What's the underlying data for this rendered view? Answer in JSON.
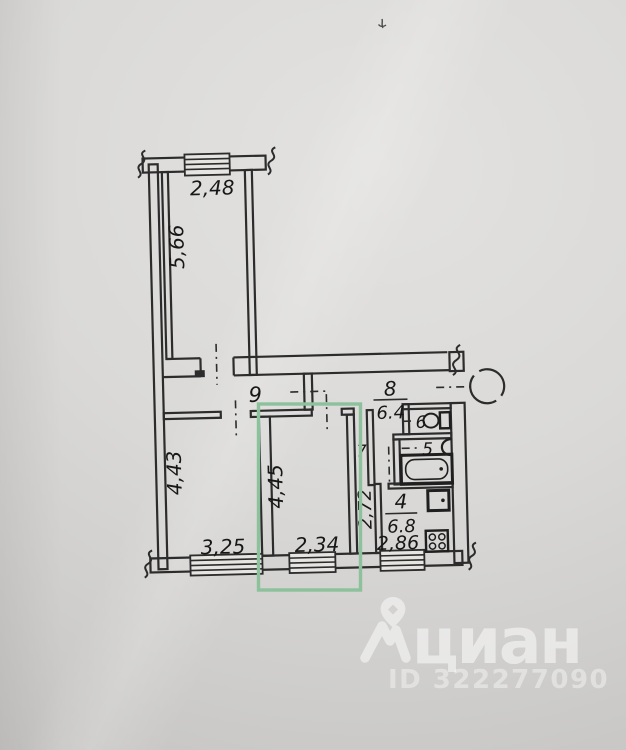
{
  "plan": {
    "labels": {
      "top_room_width": "2,48",
      "top_room_height": "5,66",
      "corridor_num": "9",
      "hall_num": "8",
      "hall_area": "6.4",
      "wc_num": "6",
      "bath_num": "5",
      "closet_num": "7",
      "closet_length": "2,72",
      "left_room_height": "4,43",
      "left_room_width": "3,25",
      "mid_room_height": "4,45",
      "mid_room_width": "2,34",
      "kitchen_num": "4",
      "kitchen_area": "6.8",
      "kitchen_width": "2,86"
    },
    "highlight_color": "#8cc19c",
    "line_color": "#2c2c2c"
  },
  "watermark": {
    "brand": "циан",
    "listing_id": "ID 322277090"
  }
}
